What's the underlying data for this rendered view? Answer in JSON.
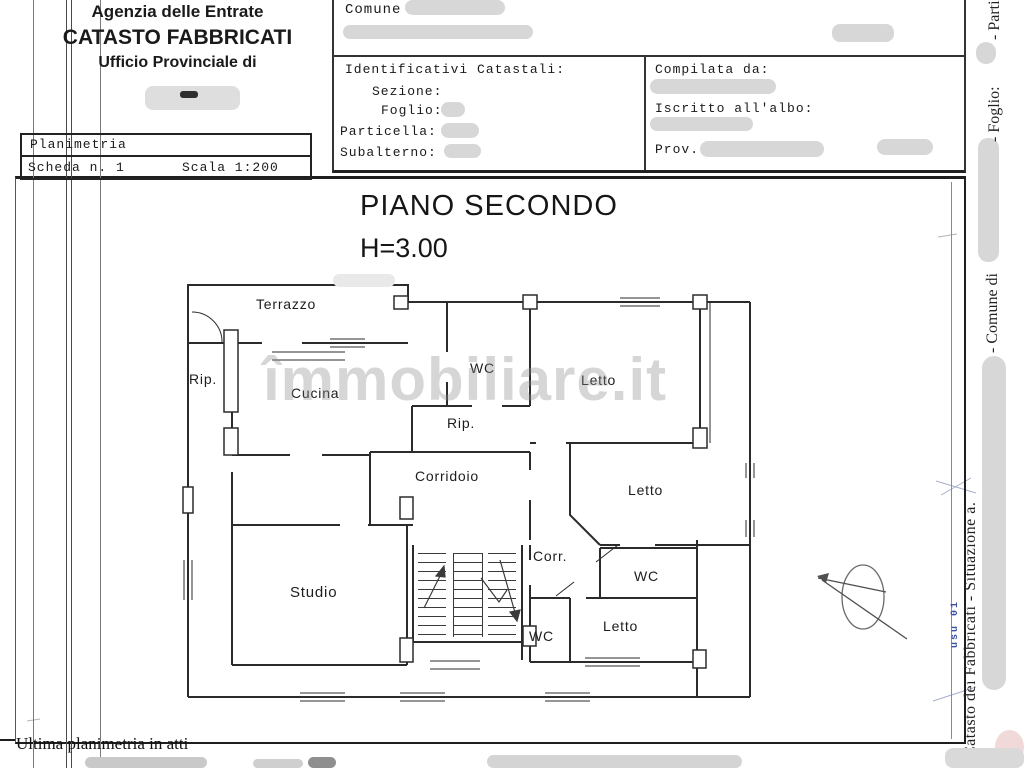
{
  "document": {
    "agency_line1": "Agenzia delle Entrate",
    "agency_line2": "CATASTO FABBRICATI",
    "agency_line3": "Ufficio Provinciale di",
    "footer_note": "Ultima planimetria in atti"
  },
  "planimetria_box": {
    "title": "Planimetria",
    "scheda": "Scheda n. 1",
    "scala": "Scala 1:200"
  },
  "form": {
    "comune_label": "Comune di",
    "identificativi_title": "Identificativi Catastali:",
    "sezione_label": "Sezione:",
    "foglio_label": "Foglio:",
    "particella_label": "Particella:",
    "subalterno_label": "Subalterno:",
    "compilata_label": "Compilata da:",
    "iscritto_label": "Iscritto all'albo:",
    "prov_label": "Prov."
  },
  "plan": {
    "title": "PIANO SECONDO",
    "height_label": "H=3.00",
    "rooms": [
      "Terrazzo",
      "Rip.",
      "Cucina",
      "WC",
      "Letto",
      "Rip.",
      "Corridoio",
      "Letto",
      "Studio",
      "Corr.",
      "WC",
      "WC",
      "Letto"
    ]
  },
  "side_strip": {
    "segment_parti": "- Parti",
    "segment_foglio": "- Foglio:",
    "segment_comune": "- Comune di",
    "segment_catasto": "Catasto dei Fabbricati - Situazione a.",
    "blue_note": "usu 01"
  },
  "watermark": {
    "text": "îmmobiliare.it"
  },
  "colors": {
    "wall": "#2b2b2b",
    "redaction": "#d7d7d7",
    "blue_note": "#3f51a5"
  }
}
